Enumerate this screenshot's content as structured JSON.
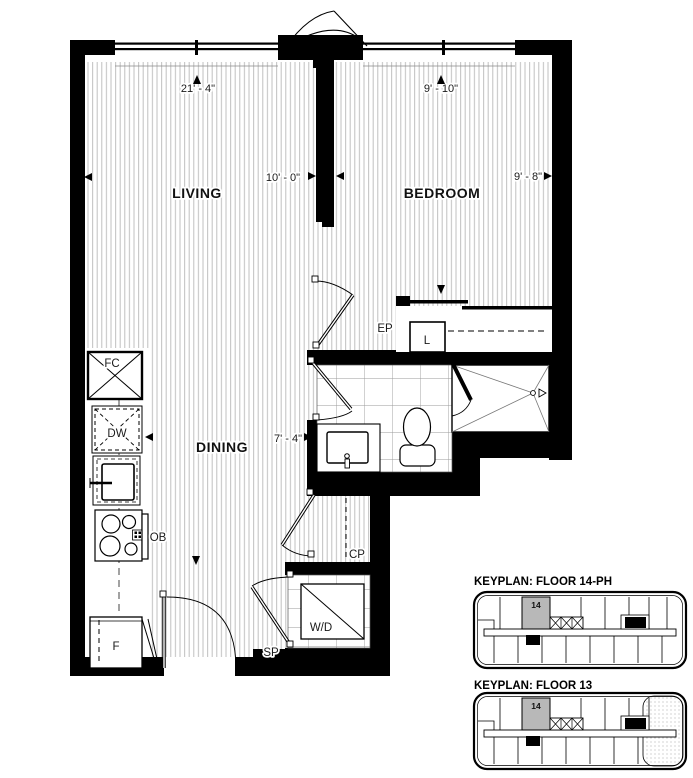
{
  "plan": {
    "room_labels": {
      "living": "LIVING",
      "bedroom": "BEDROOM",
      "dining": "DINING"
    },
    "dims": {
      "living_length": "21' - 4\"",
      "bedroom_depth": "9' - 10\"",
      "living_width": "10' - 0\"",
      "bedroom_width": "9' - 8\"",
      "hall_width": "7' - 4\""
    },
    "fixtures": {
      "fc": "FC",
      "dw": "DW",
      "ob": "OB",
      "f": "F",
      "l": "L",
      "ep": "EP",
      "cp": "CP",
      "sp": "SP",
      "wd": "W/D"
    }
  },
  "keyplans": [
    {
      "title": "KEYPLAN: FLOOR 14-PH",
      "unit": "14"
    },
    {
      "title": "KEYPLAN: FLOOR 13",
      "unit": "14"
    }
  ],
  "colors": {
    "wall": "#000000",
    "floor_hatch": "#c0c0c0",
    "tile_line": "#999999",
    "keyplan_unit_fill": "#b8b8b8",
    "text": "#1a1a1a"
  }
}
